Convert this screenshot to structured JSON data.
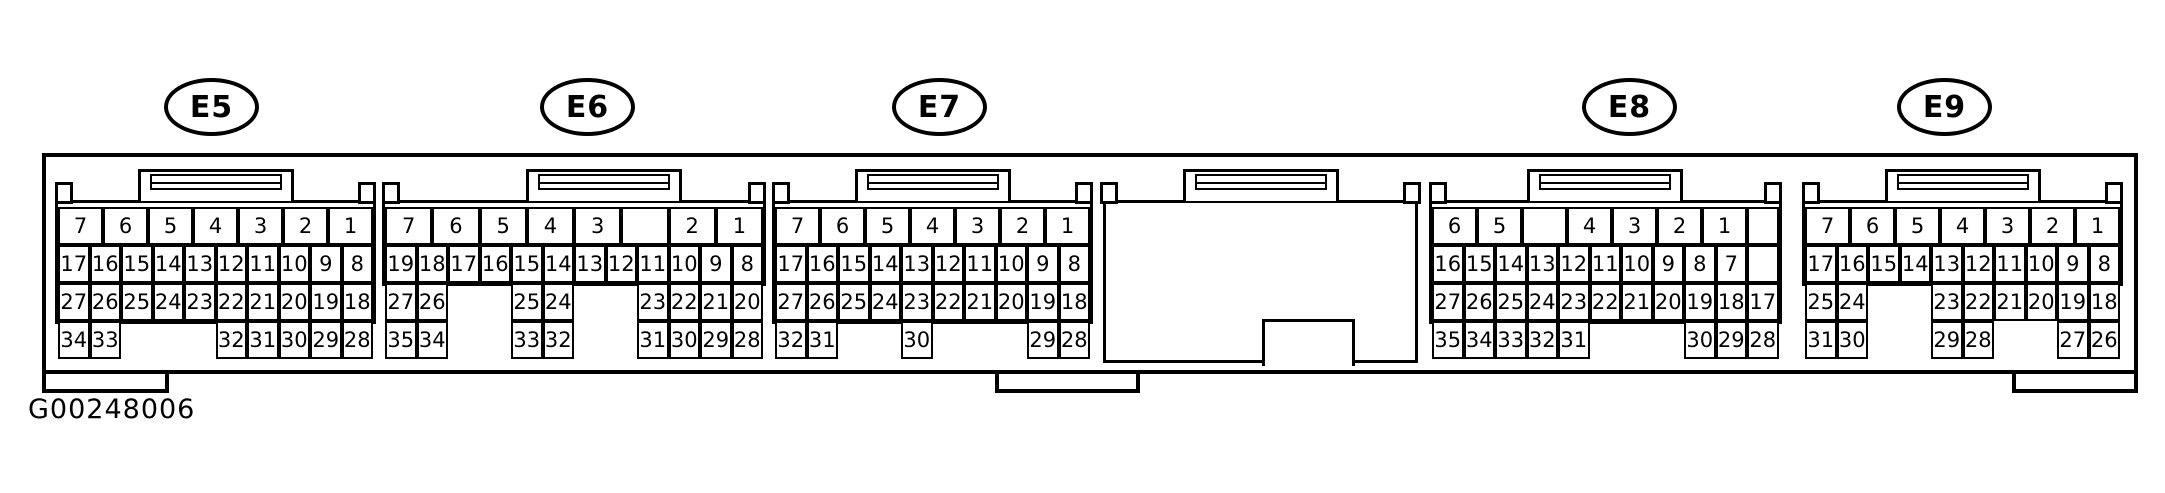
{
  "figure": {
    "code": "G00248006"
  },
  "connectors": [
    {
      "label": "E5",
      "rows": [
        {
          "wide": true,
          "cells": [
            "7",
            "6",
            "5",
            "4",
            "3",
            "2",
            "1"
          ]
        },
        {
          "cells": [
            "17",
            "16",
            "15",
            "14",
            "13",
            "12",
            "11",
            "10",
            "9",
            "8"
          ]
        },
        {
          "cells": [
            "27",
            "26",
            "25",
            "24",
            "23",
            "22",
            "21",
            "20",
            "19",
            "18"
          ]
        },
        {
          "cells": [
            "34",
            "33",
            null,
            null,
            null,
            "32",
            "31",
            "30",
            "29",
            "28"
          ]
        }
      ]
    },
    {
      "label": "E6",
      "rows": [
        {
          "wide": true,
          "cells": [
            "7",
            "6",
            "5",
            "4",
            "3",
            "",
            "2",
            "1"
          ]
        },
        {
          "cells": [
            "19",
            "18",
            "17",
            "16",
            "15",
            "14",
            "13",
            "12",
            "11",
            "10",
            "9",
            "8"
          ]
        },
        {
          "cells": [
            "27",
            "26",
            null,
            null,
            "25",
            "24",
            null,
            null,
            "23",
            "22",
            "21",
            "20"
          ]
        },
        {
          "cells": [
            "35",
            "34",
            null,
            null,
            "33",
            "32",
            null,
            null,
            "31",
            "30",
            "29",
            "28"
          ]
        }
      ]
    },
    {
      "label": "E7",
      "rows": [
        {
          "wide": true,
          "cells": [
            "7",
            "6",
            "5",
            "4",
            "3",
            "2",
            "1"
          ]
        },
        {
          "cells": [
            "17",
            "16",
            "15",
            "14",
            "13",
            "12",
            "11",
            "10",
            "9",
            "8"
          ]
        },
        {
          "cells": [
            "27",
            "26",
            "25",
            "24",
            "23",
            "22",
            "21",
            "20",
            "19",
            "18"
          ]
        },
        {
          "cells": [
            "32",
            "31",
            null,
            null,
            "30",
            null,
            null,
            null,
            "29",
            "28"
          ]
        }
      ]
    },
    {
      "label": "",
      "blank": true,
      "rows": []
    },
    {
      "label": "E8",
      "right_blank_cells": 2,
      "rows": [
        {
          "wide": true,
          "span": 10,
          "cells": [
            "6",
            "5",
            "",
            "4",
            "3",
            "2",
            "1"
          ]
        },
        {
          "cells": [
            "16",
            "15",
            "14",
            "13",
            "12",
            "11",
            "10",
            "9",
            "8",
            "7"
          ]
        },
        {
          "cells": [
            "27",
            "26",
            "25",
            "24",
            "23",
            "22",
            "21",
            "20",
            "19",
            "18",
            "17"
          ]
        },
        {
          "cells": [
            "35",
            "34",
            "33",
            "32",
            "31",
            null,
            null,
            null,
            "30",
            "29",
            "28"
          ]
        }
      ]
    },
    {
      "label": "E9",
      "rows": [
        {
          "wide": true,
          "cells": [
            "7",
            "6",
            "5",
            "4",
            "3",
            "2",
            "1"
          ]
        },
        {
          "cells": [
            "17",
            "16",
            "15",
            "14",
            "13",
            "12",
            "11",
            "10",
            "9",
            "8"
          ]
        },
        {
          "cells": [
            "25",
            "24",
            null,
            null,
            "23",
            "22",
            "21",
            "20",
            "19",
            "18"
          ]
        },
        {
          "cells": [
            "31",
            "30",
            null,
            null,
            "29",
            "28",
            null,
            null,
            "27",
            "26"
          ]
        }
      ]
    }
  ]
}
